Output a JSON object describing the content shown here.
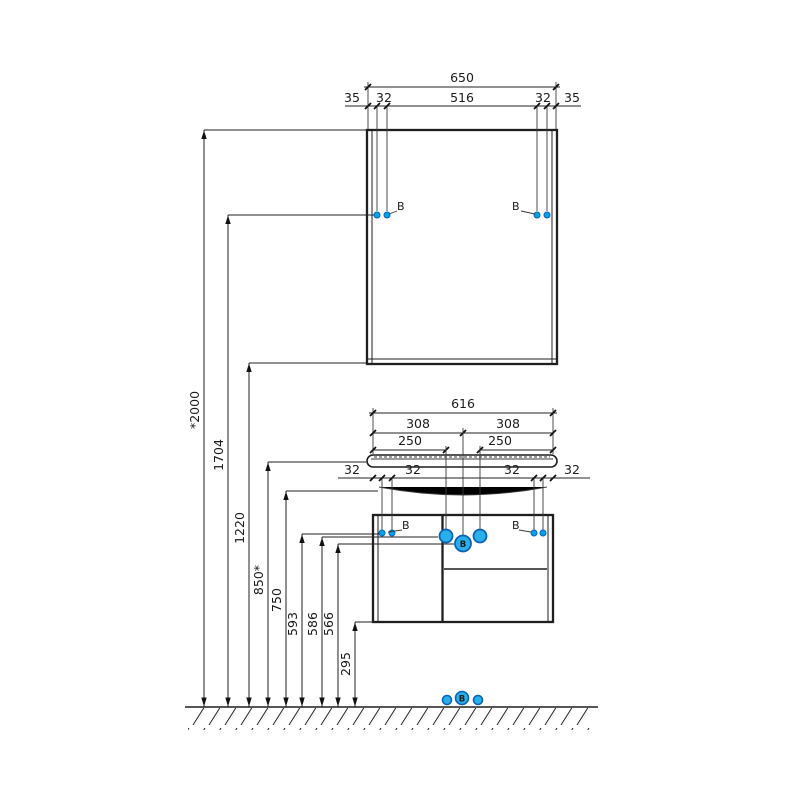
{
  "drawing": {
    "type": "installation-dimension-drawing",
    "objects": [
      "wall-mirror",
      "washbasin-vanity-unit",
      "floor-line"
    ]
  },
  "colors": {
    "accent_blue": "#00a2e8",
    "accent_blue_dark": "#0b62b8",
    "line_black": "#1f1f1f"
  },
  "labels": {
    "mount_b": "B",
    "circle_b": "B"
  },
  "mirror_dims": {
    "overall": "650",
    "margin_left": "35",
    "hole_left": "32",
    "center": "516",
    "hole_right": "32",
    "margin_right": "35"
  },
  "vanity_dims": {
    "overall": "616",
    "half_left": "308",
    "half_right": "308",
    "offset_left": "250",
    "offset_right": "250",
    "t32_edge_left": "32",
    "t32_hole_left": "32",
    "t32_hole_right": "32",
    "t32_edge_right": "32"
  },
  "height_dims": {
    "h2000": "*2000",
    "h1704": "1704",
    "h1220": "1220",
    "h850": "850*",
    "h750": "750",
    "h593": "593",
    "h586": "586",
    "h566": "566",
    "h295": "295"
  }
}
